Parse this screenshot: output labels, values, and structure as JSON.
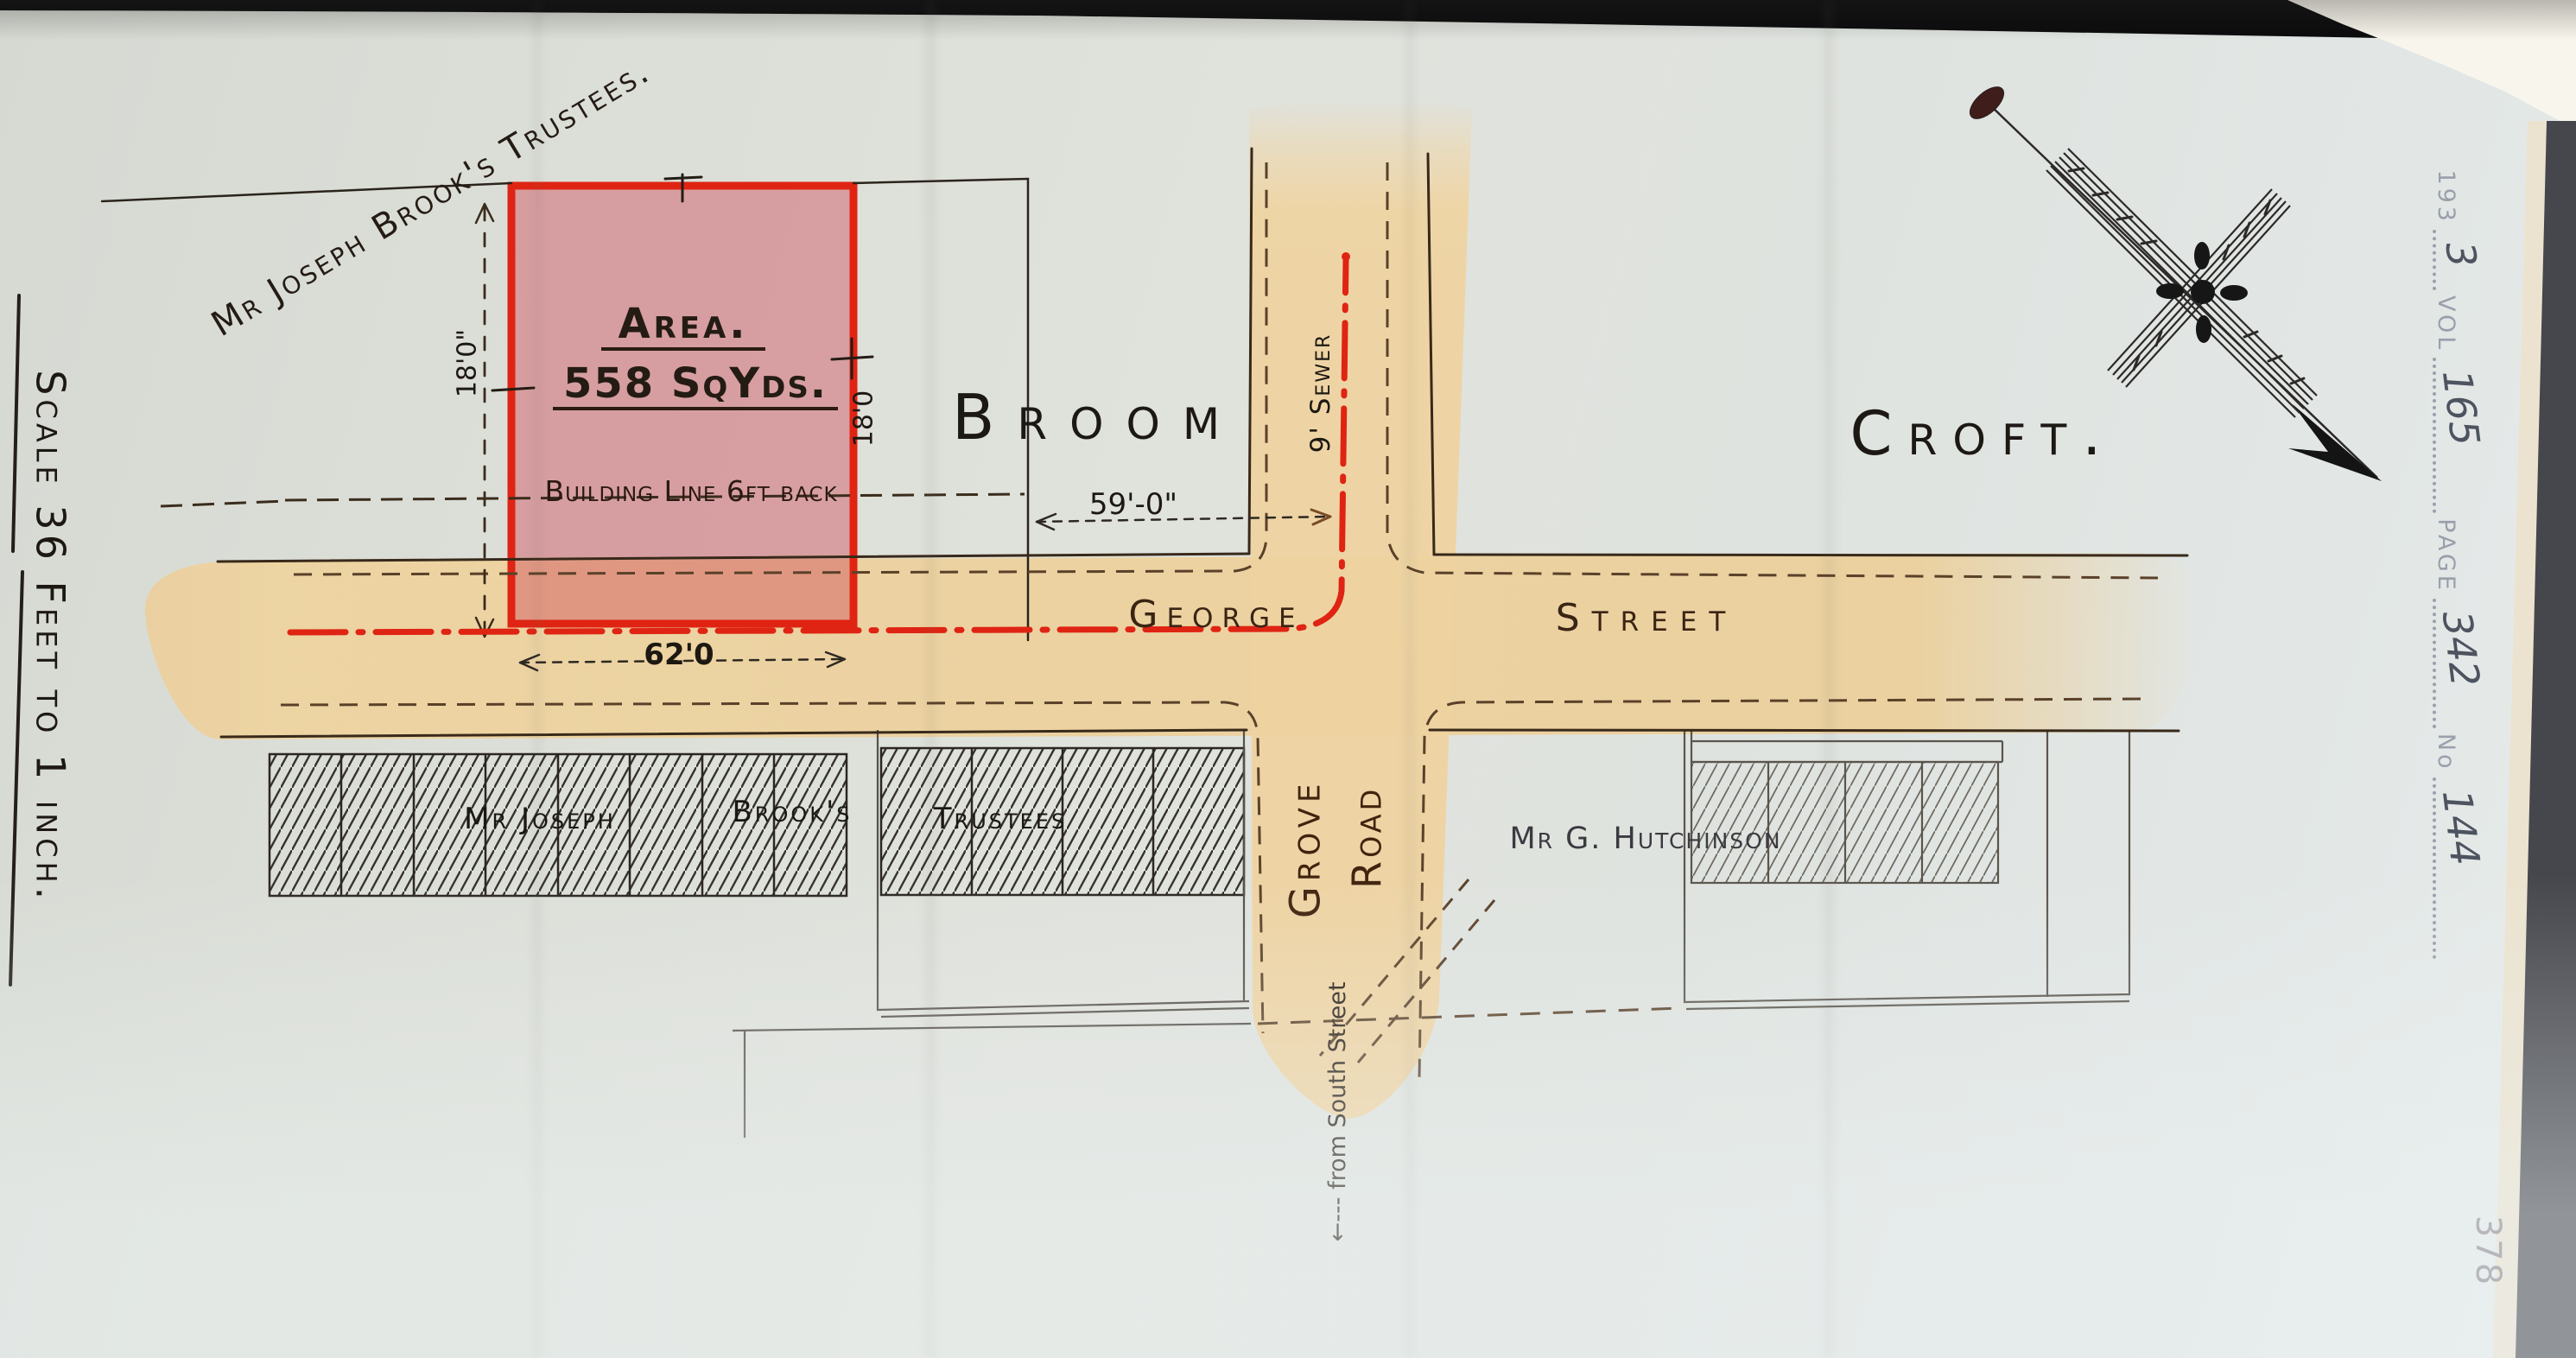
{
  "page": {
    "scale_label": "Scale 36 Feet to 1 inch.",
    "page_number": "378",
    "stamp": {
      "series": "193",
      "series_value": "3",
      "vol_label": "VOL",
      "vol_value": "165",
      "page_label": "PAGE",
      "page_value": "342",
      "no_label": "No",
      "no_value": "144"
    }
  },
  "plan": {
    "north_owner_label": "Mr Joseph Brook's Trustees.",
    "plot": {
      "area_title": "Area.",
      "area_value": "558 SqYds.",
      "building_line": "Building Line 6ft back",
      "frontage": "62'0",
      "depth_left": "18'0\"",
      "depth_right": "18'0",
      "dim_to_sewer": "59'-0\""
    },
    "fields": {
      "left": "Broom",
      "right": "Croft."
    },
    "streets": {
      "george_1": "George",
      "george_2": "Street",
      "grove_1": "Grove",
      "grove_2": "Road",
      "sewer": "9' Sewer",
      "from_south": "←--- from South Street"
    },
    "south_terrace": {
      "label_1": "Mr Joseph",
      "label_2": "Brook's",
      "label_3": "Trustees"
    },
    "hutchinson_label": "Mr G. Hutchinson",
    "colors": {
      "road": "#eed3a0",
      "plot_fill": "#cf4b58",
      "ink_red": "#df2413",
      "ink_black": "#241c14",
      "ink_brown": "#5a4129",
      "stamp_grey": "#99a0ab"
    }
  }
}
